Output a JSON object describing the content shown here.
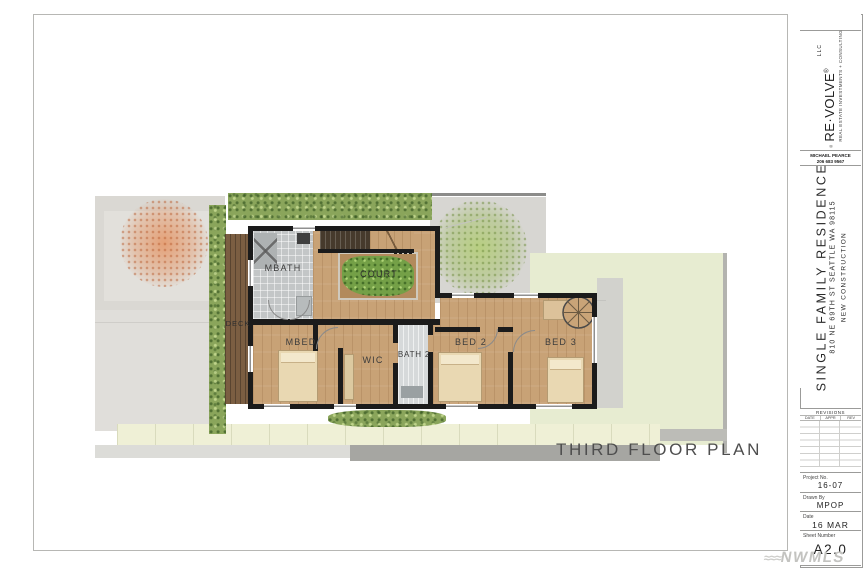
{
  "plan": {
    "title": "THIRD FLOOR PLAN",
    "rooms": [
      {
        "label": "MBATH"
      },
      {
        "label": "COURT"
      },
      {
        "label": "DECK"
      },
      {
        "label": "MBED"
      },
      {
        "label": "WIC"
      },
      {
        "label": "BATH 2"
      },
      {
        "label": "BED 2"
      },
      {
        "label": "BED 3"
      }
    ],
    "colors": {
      "wood": "#c8a276",
      "deck": "#7b5e42",
      "wall": "#1b1b1b",
      "lawn": "#e7ecd1",
      "hedge": "#8aa55b",
      "court_foliage": "#74a047"
    }
  },
  "titleblock": {
    "brand": {
      "name": "RE·VOLVE",
      "registered": "®",
      "entity": "LLC",
      "tagline": "REAL ESTATE INVESTMENTS + CONSULTING"
    },
    "contact": {
      "name": "MICHAEL PEARCE",
      "phone": "206 683 9567"
    },
    "project": {
      "name": "SINGLE FAMILY RESIDENCE",
      "address": "810 NE 69TH ST SEATTLE WA 98115",
      "type": "NEW CONSTRUCTION"
    },
    "revisions": {
      "title": "REVISIONS",
      "columns": [
        "DATE",
        "APPR",
        "REV"
      ]
    },
    "fields": {
      "project_no_label": "Project No.",
      "project_no": "16-07",
      "drawn_by_label": "Drawn By",
      "drawn_by": "MPOP",
      "date_label": "Date",
      "date": "16 MAR 2019",
      "sheet_label": "Sheet Number",
      "sheet": "A2.0"
    }
  },
  "watermark": {
    "waves": "≈≈≈",
    "text": "NWMLS"
  }
}
